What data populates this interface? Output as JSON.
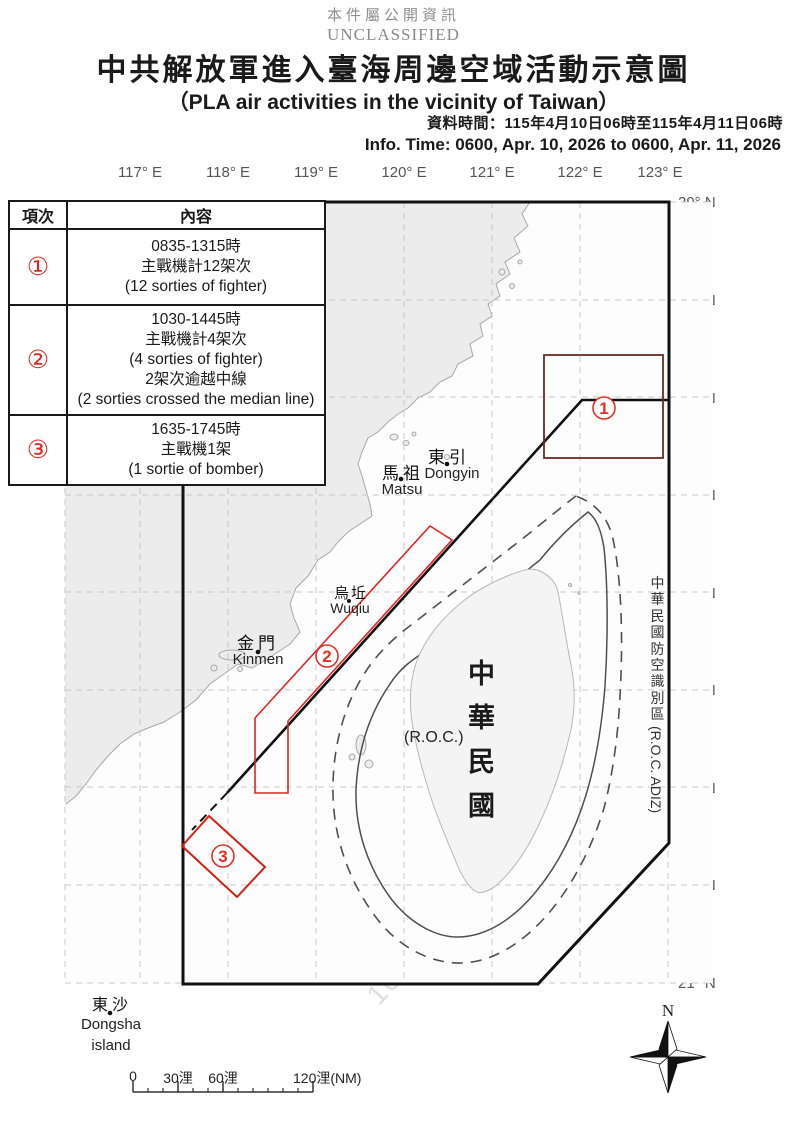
{
  "header": {
    "notice_zh": "本件屬公開資訊",
    "notice_en": "UNCLASSIFIED",
    "title_zh": "中共解放軍進入臺海周邊空域活動示意圖",
    "title_en": "（PLA air activities in the vicinity of Taiwan）",
    "info_zh": "資料時間：115年4月10日06時至115年4月11日06時",
    "info_en": "Info. Time: 0600, Apr. 10, 2026 to 0600, Apr. 11, 2026"
  },
  "table": {
    "headers": {
      "item": "項次",
      "content": "內容"
    },
    "rows": [
      {
        "num": "①",
        "lines": [
          "0835-1315時",
          "主戰機計12架次",
          "(12 sorties of fighter)"
        ]
      },
      {
        "num": "②",
        "lines": [
          "1030-1445時",
          "主戰機計4架次",
          "(4 sorties of fighter)",
          "2架次逾越中線",
          "(2 sorties crossed the median line)"
        ]
      },
      {
        "num": "③",
        "lines": [
          "1635-1745時",
          "主戰機1架",
          "(1 sortie of bomber)"
        ]
      }
    ]
  },
  "axes": {
    "lon": [
      "117° E",
      "118° E",
      "119° E",
      "120° E",
      "121° E",
      "122° E",
      "123° E"
    ],
    "lat": [
      "29° N",
      "28° N",
      "27° N",
      "26° N",
      "25° N",
      "24° N",
      "23° N",
      "22° N",
      "21° N"
    ]
  },
  "map": {
    "adiz_zh": "中\n華\n民\n國\n防\n空\n識\n別\n區",
    "adiz_en": "(R.O.C. ADIZ)",
    "roc_zh": "中\n華\n民\n國",
    "roc_en": "(R.O.C.)",
    "places": {
      "dongyin_zh": "東引",
      "dongyin_en": "Dongyin",
      "matsu_zh": "馬祖",
      "matsu_en": "Matsu",
      "wuqiu_zh": "烏坵",
      "wuqiu_en": "Wuqiu",
      "kinmen_zh": "金門",
      "kinmen_en": "Kinmen",
      "dongsha_zh": "東沙",
      "dongsha_en": "Dongsha",
      "dongsha_en2": "island"
    },
    "markers": [
      "1",
      "2",
      "3"
    ],
    "compass": "N",
    "scale": {
      "t0": "0",
      "t30": "30浬",
      "t60": "60浬",
      "t120": "120浬(NM)"
    },
    "watermark": "10.177.110.91"
  }
}
